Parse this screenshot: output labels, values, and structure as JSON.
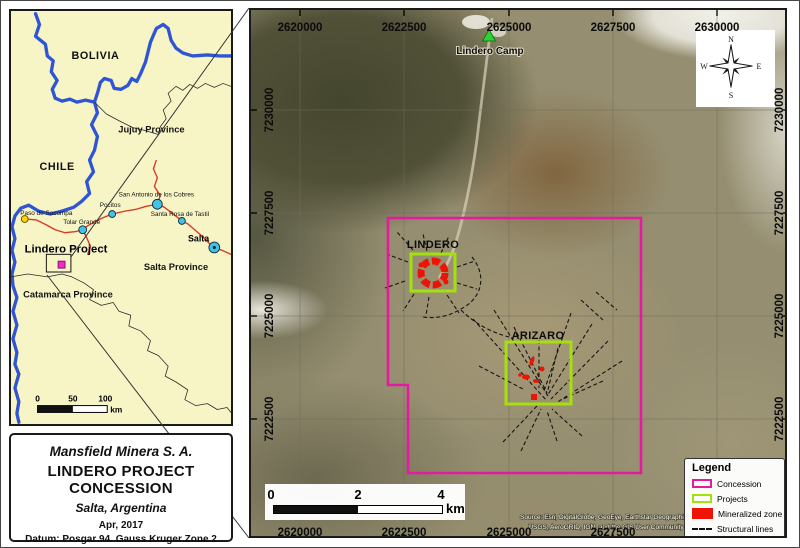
{
  "colors": {
    "concession": "#e51aa0",
    "projects": "#a4e00e",
    "mineralized": "#ee1405",
    "blue_border": "#2f55d4",
    "road_red": "#d93a25",
    "inset_bg": "#f7f5c6",
    "camp_green": "#2fd135",
    "town_cyan": "#41c2e6",
    "town_yellow": "#ffd400"
  },
  "inset": {
    "countries": {
      "bolivia": "BOLIVIA",
      "chile": "CHILE"
    },
    "provinces": {
      "jujuy": "Jujuy Province",
      "salta": "Salta Province",
      "catamarca": "Catamarca Province"
    },
    "towns": {
      "paso_de_socompa": "Paso de Socompa",
      "tolar_grande": "Tolar Grande",
      "pocitos": "Pocitos",
      "san_antonio": "San Antonio de los Cobres",
      "santa_rosa": "Santa Rosa de Tastil",
      "salta_city": "Salta"
    },
    "project_label": "Lindero Project",
    "scalebar": {
      "t0": "0",
      "t50": "50",
      "t100": "100",
      "unit": "km"
    }
  },
  "title_block": {
    "company": "Mansfield Minera S. A.",
    "project": "LINDERO PROJECT",
    "subtitle": "CONCESSION",
    "location": "Salta, Argentina",
    "date": "Apr, 2017",
    "datum": "Datum: Posgar 94. Gauss Kruger Zone 2"
  },
  "map": {
    "x_ticks": [
      "2620000",
      "2622500",
      "2625000",
      "2627500",
      "2630000"
    ],
    "y_ticks": [
      "7230000",
      "7227500",
      "7225000",
      "7222500"
    ],
    "camp_label": "Lindero Camp",
    "lindero_label": "LINDERO",
    "arizaro_label": "ARIZARO",
    "compass": {
      "n": "N",
      "e": "E",
      "s": "S",
      "w": "W"
    },
    "scalebar": {
      "t0": "0",
      "t2": "2",
      "t4": "4",
      "unit": "km"
    },
    "legend": {
      "title": "Legend",
      "items": [
        {
          "label": "Concession"
        },
        {
          "label": "Projects"
        },
        {
          "label": "Mineralized zone"
        },
        {
          "label": "Structural lines"
        }
      ]
    },
    "attribution_line1": "Source: Esri, DigitalGlobe, GeoEye, Earthstar Geographics,",
    "attribution_line2": "USGS, AeroGRID, IGN, and the GIS User Community"
  }
}
